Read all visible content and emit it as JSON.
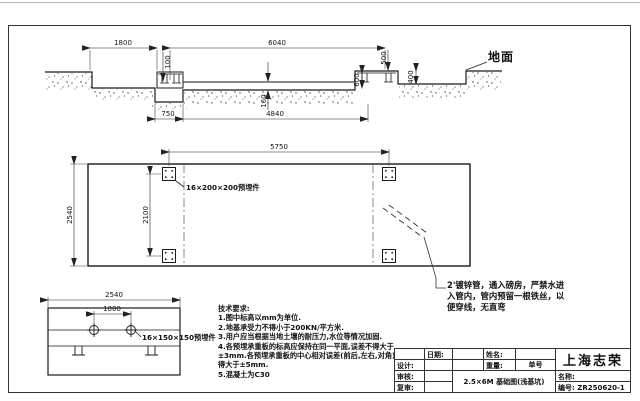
{
  "sheet": {
    "company": "上海志荣",
    "drawing_title": "2.5×6M 基础图(浅基坑)",
    "drawing_number": "ZR250620-1"
  },
  "section": {
    "ground_label": "地面",
    "dims": {
      "approach": "1800",
      "pit_length": "6040",
      "step": "100",
      "end_height": "500",
      "slab_thickness": "160",
      "ledge_depth": "400",
      "block_height": "600",
      "sump_width": "750",
      "clear_span": "4840"
    }
  },
  "plan": {
    "dims": {
      "plate_span": "5750",
      "width": "2540",
      "plate_spacing": "2100"
    },
    "plate_label": "16×200×200预埋件"
  },
  "detail": {
    "dims": {
      "width": "2540",
      "plate_spacing": "1000"
    },
    "plate_label": "16×150×150预埋件"
  },
  "tech_notes": {
    "lines": [
      "技术要求:",
      "1.图中标高以mm为单位.",
      "2.地基承受力不得小于200KN/平方米.",
      "3.用户应当根据当地土壤的耐压力,水位等情况加固.",
      "4.各预埋承重板的标高应保持在同一平面,误差不得大于",
      "±3mm.各预埋承重板的中心相对误差(前后,左右,对角)不",
      "得大于±5mm.",
      "5.混凝土为C30"
    ]
  },
  "pipe_note": {
    "lines": [
      "2'镀锌管，通入磅房，严禁水进",
      "入管内，管内预留一根铁丝，以",
      "便穿线，无直弯"
    ]
  },
  "title_block": {
    "date_label": "日期:",
    "name_label": "姓名:",
    "weight_label": "重量:",
    "order_label": "单号",
    "designer_label": "设计:",
    "checker_label": "审核:",
    "reviewer_label": "复审:",
    "company": "上海志荣",
    "title": "2.5×6M 基础图(浅基坑)",
    "product_name_label": "名称:",
    "number_label": "编号:",
    "number": "ZR250620-1"
  }
}
